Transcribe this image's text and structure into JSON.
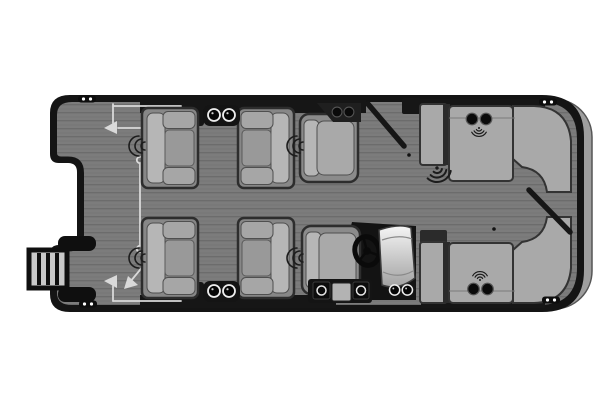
{
  "diagram": {
    "label": "Pontoon boat floor plan, top-down view",
    "type": "pontoon-boat-floor-plan",
    "palette": {
      "background": "#ffffff",
      "hull_black": "#141414",
      "deck_gray": "#7c7c7c",
      "plank_line": "#6c6c6c",
      "cushion_gray": "#a9a9a9",
      "cushion_highlight": "#b6b6b6",
      "seat_base": "#878787",
      "swing_guide": "#d9d9d9",
      "stern_tube": "#9e9e9e",
      "cup_ring_white": "#ededed"
    },
    "components": {
      "bow_ladder": {
        "label": "bow boarding ladder",
        "rungs": 3
      },
      "cleats": {
        "count": 4,
        "positions": [
          "bow top",
          "bow bottom",
          "stern top",
          "stern bottom"
        ]
      },
      "chaise_lounges": {
        "count": 4,
        "arrangement": "two facing pairs at bow"
      },
      "companion_chair": {
        "count": 1
      },
      "helm": {
        "captain_chair": 1,
        "console": 1,
        "steering_wheel": 1,
        "windshield": 1,
        "cup_holders": 2,
        "footrest_speaker_boxes": 2,
        "cooler_box": 1
      },
      "stern_lounges": {
        "count": 2,
        "shape": "L-shaped wraparound with curved corner"
      },
      "cup_holder_pairs": {
        "count": 6
      },
      "speaker_icons": {
        "small_side": 4,
        "medium_radiating": 2,
        "large_radiating": 1
      },
      "gates": {
        "bow_gate": "closed, swing guides drawn",
        "side_gate_top": "open, shown diagonal",
        "stern_gate": "open, shown diagonal"
      },
      "swing_guides": {
        "count": 3,
        "style": "thin light lines with arrows and end rings"
      }
    }
  }
}
